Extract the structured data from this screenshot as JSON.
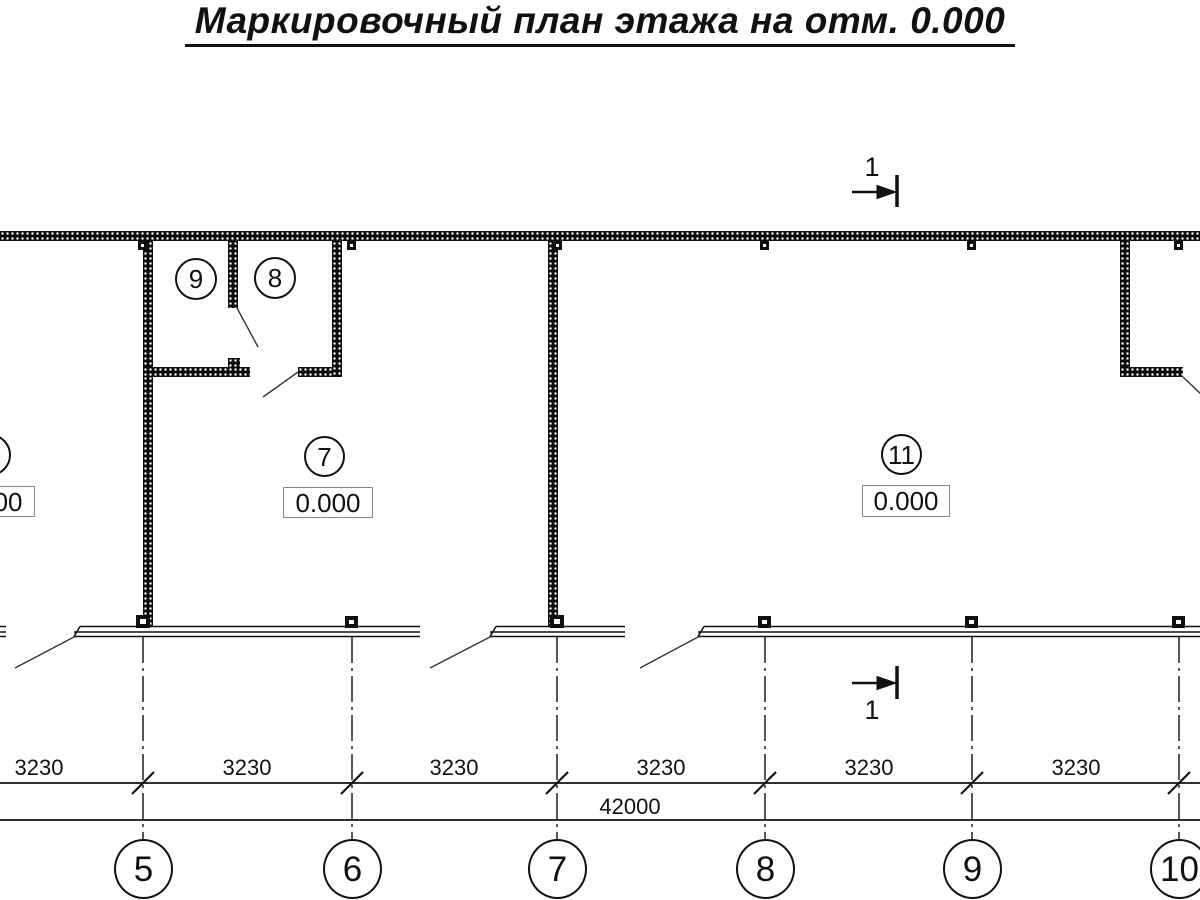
{
  "title": "Маркировочный план этажа на отм. 0.000",
  "section_marks": {
    "top_label": "1",
    "bottom_label": "1"
  },
  "rooms": {
    "room9": {
      "number": "9"
    },
    "room8": {
      "number": "8"
    },
    "room7": {
      "number": "7",
      "elevation": "0.000"
    },
    "room11": {
      "number": "11",
      "elevation": "0.000"
    },
    "room_left": {
      "elevation": "0.000"
    }
  },
  "dimensions": {
    "bay_labels": [
      "3230",
      "3230",
      "3230",
      "3230",
      "3230",
      "3230"
    ],
    "total_label": "42000"
  },
  "grid_axes": {
    "labels": [
      "5",
      "6",
      "7",
      "8",
      "9",
      "10"
    ]
  },
  "colors": {
    "ink": "#111111",
    "paper": "#ffffff",
    "box_border": "#8a8a8a"
  }
}
